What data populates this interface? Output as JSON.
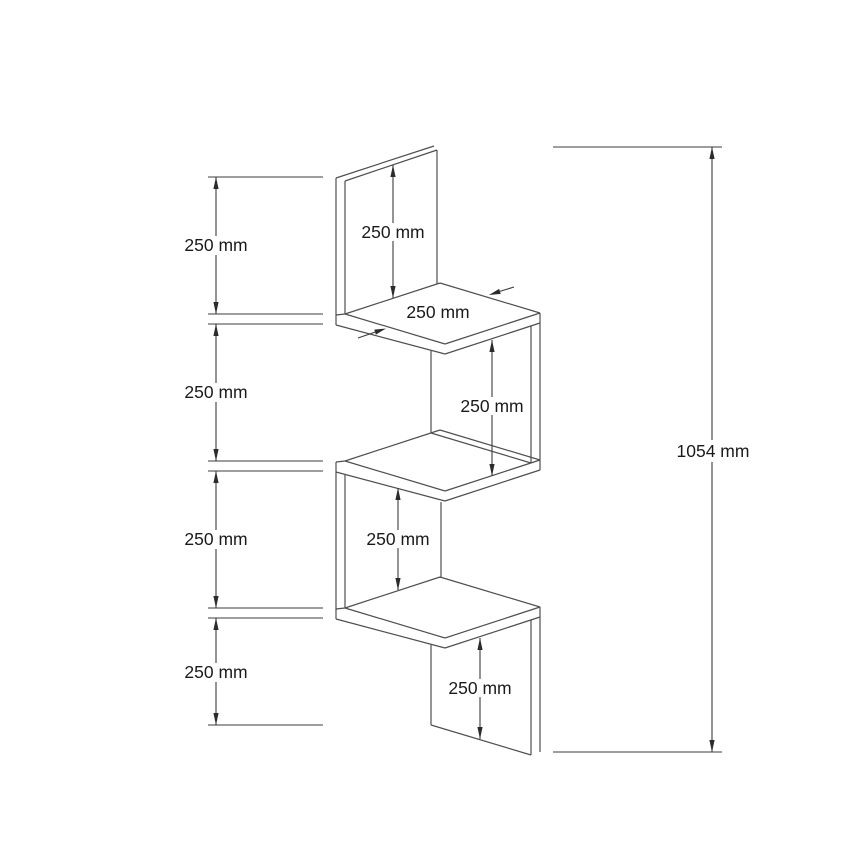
{
  "diagram": {
    "type": "technical-dimension-drawing",
    "subject": "zigzag corner wall shelf with four shelf tiers",
    "colors": {
      "background": "#ffffff",
      "line": "#4f4f4f",
      "text": "#1a1a1a"
    },
    "labels": {
      "left_segment_1": "250 mm",
      "left_segment_2": "250 mm",
      "left_segment_3": "250 mm",
      "left_segment_4": "250 mm",
      "overall_height": "1054 mm",
      "back_panel_height": "250 mm",
      "shelf_depth": "250 mm",
      "upper_gap": "250 mm",
      "lower_gap": "250 mm",
      "bottom_panel_height": "250 mm"
    }
  }
}
